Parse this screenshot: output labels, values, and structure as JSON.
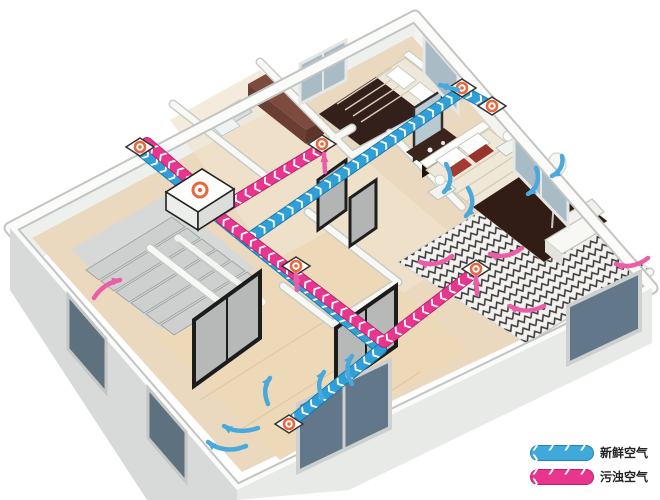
{
  "legend": {
    "items": [
      {
        "id": "fresh-air",
        "label": "新鲜空气",
        "chevrons": "❯ ❯ ❯ ❯ ❯",
        "color": "#3fa9dc"
      },
      {
        "id": "polluted-air",
        "label": "污浊空气",
        "chevrons": "❯ ❯ ❯ ❯ ❯",
        "color": "#e8368f"
      }
    ]
  },
  "ducts": {
    "chevrons": "❯❯❯❯❯❯❯❯❯❯❯❯❯❯❯❯❯❯❯❯❯❯❯❯❯❯❯❯❯❯❯❯❯❯❯❯❯❯❯❯",
    "fresh_color": "#2f9fd8",
    "exhaust_color": "#e8368f"
  },
  "colors": {
    "vent_ring_orange": "#e5693f",
    "floor_wood": "#ead9bf",
    "wall_white": "#f8f8f5",
    "wall_shadow": "#c9ccc9",
    "window_glass": "#a9bcc6",
    "bed_blanket_brown": "#33201a",
    "arrow_blue": "#4aa9dc",
    "arrow_pink": "#ea5ea8"
  },
  "components": {
    "unit": {
      "id": "hrv-unit",
      "role": "heat-recovery-ventilation-unit"
    },
    "vents": [
      {
        "id": "outdoor-louver",
        "role": "outdoor-intake-exhaust"
      },
      {
        "id": "hall-upper-exhaust",
        "role": "exhaust"
      },
      {
        "id": "top-bedroom-supply",
        "role": "supply"
      },
      {
        "id": "master-supply",
        "role": "supply"
      },
      {
        "id": "hall-lower-exhaust",
        "role": "exhaust"
      },
      {
        "id": "master-exhaust",
        "role": "exhaust"
      },
      {
        "id": "living-supply",
        "role": "supply"
      }
    ]
  }
}
